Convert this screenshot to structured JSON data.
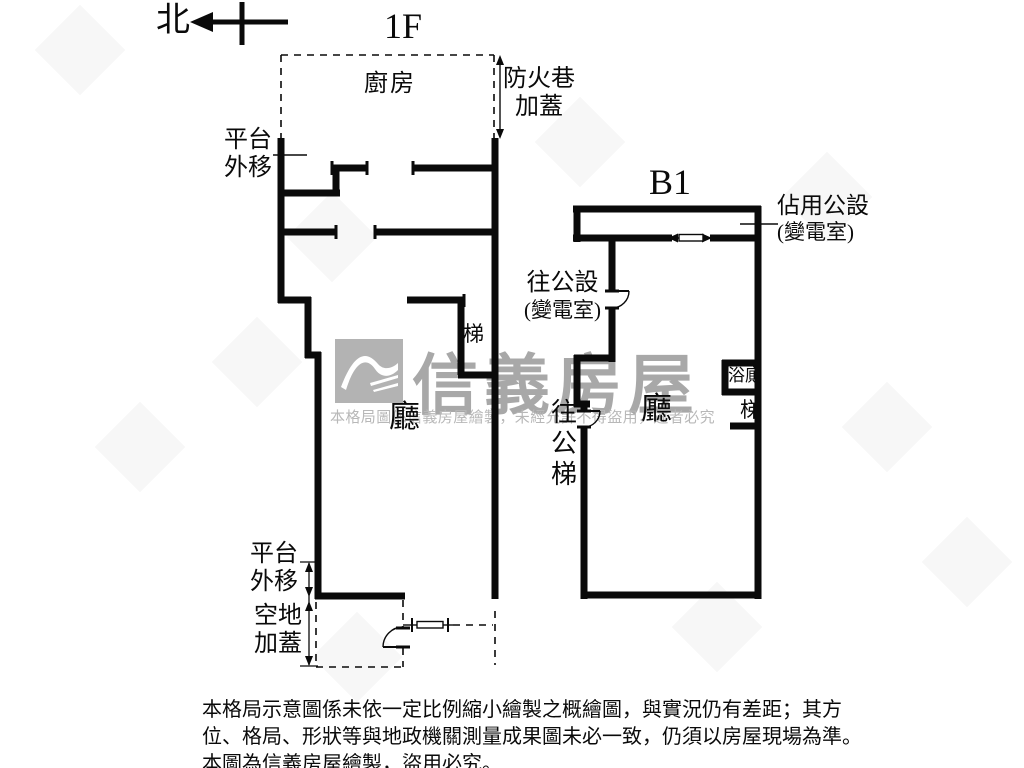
{
  "compass": {
    "north_label": "北"
  },
  "plans": {
    "f1": {
      "title": "1F",
      "kitchen": "廚房",
      "fire_lane_l1": "防火巷",
      "fire_lane_l2": "加蓋",
      "platform_top_l1": "平台",
      "platform_top_l2": "外移",
      "stairs": "梯",
      "hall": "廳",
      "platform_bottom_l1": "平台",
      "platform_bottom_l2": "外移",
      "vacant_l1": "空地",
      "vacant_l2": "加蓋"
    },
    "b1": {
      "title": "B1",
      "occupied_l1": "佔用公設",
      "occupied_l2": "(變電室)",
      "to_common_l1": "往公設",
      "to_common_l2": "(變電室)",
      "bath": "浴廁",
      "stairs": "梯",
      "hall": "廳",
      "to_public_stairs": {
        "c1": "往",
        "c2": "公",
        "c3": "梯"
      }
    }
  },
  "watermark": {
    "brand": "信義房屋",
    "notice": "本格局圖係信義房屋繪製，未經允許不得盜用，違者必究"
  },
  "disclaimer": {
    "l1": "本格局示意圖係未依一定比例縮小繪製之概繪圖，與實況仍有差距；其方",
    "l2": "位、格局、形狀等與地政機關測量成果圖未必一致，仍須以房屋現場為準。",
    "l3": "本圖為信義房屋繪製，盜用必究。"
  },
  "colors": {
    "wall": "#0a0a0a",
    "watermark_text": "#a8a8a8",
    "watermark_notice": "#b8b8b8",
    "logo_bg": "#b3b3b3"
  }
}
